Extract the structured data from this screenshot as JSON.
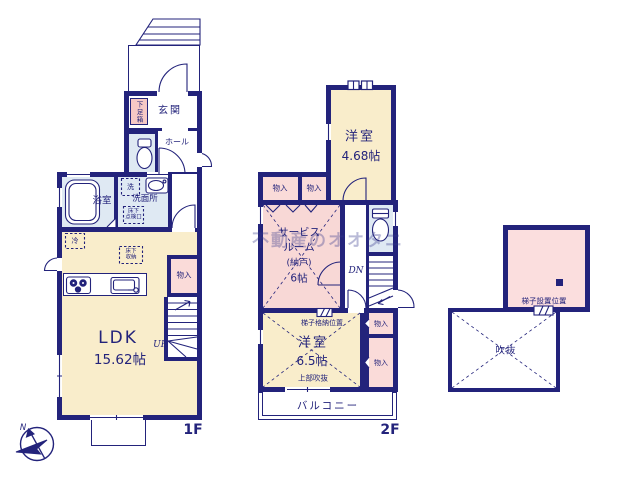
{
  "watermark": "不動産のオオタニ",
  "compass": {
    "north_label": "N"
  },
  "floor1": {
    "floor_label": "1F",
    "entrance": "玄関",
    "shoe_box": "下足箱",
    "hall": "ホール",
    "bathroom": "浴室",
    "washroom": "洗面所",
    "laundry": "洗",
    "underfloor_access_l1": "床下",
    "underfloor_access_l2": "点検口",
    "fridge": "冷",
    "underfloor_storage_l1": "床下",
    "underfloor_storage_l2": "収納",
    "closet": "物入",
    "stairs_up": "UP",
    "ldk": "LDK",
    "ldk_size": "15.62帖"
  },
  "floor2": {
    "floor_label": "2F",
    "bedroom1": "洋室",
    "bedroom1_size": "4.68帖",
    "closet_top_a": "物入",
    "closet_top_b": "物入",
    "service_room_l1": "サービス",
    "service_room_l2": "ルーム",
    "service_room_l3": "(納戸)",
    "service_room_l4": "6帖",
    "stairs_down": "DN",
    "ladder_storage": "梯子格納位置",
    "bedroom2": "洋室",
    "bedroom2_size": "6.5帖",
    "upper_void": "上部吹抜",
    "closet_right_a": "物入",
    "closet_right_b": "物入",
    "balcony": "バルコニー"
  },
  "attic": {
    "ladder_position": "梯子設置位置",
    "void": "吹抜"
  }
}
